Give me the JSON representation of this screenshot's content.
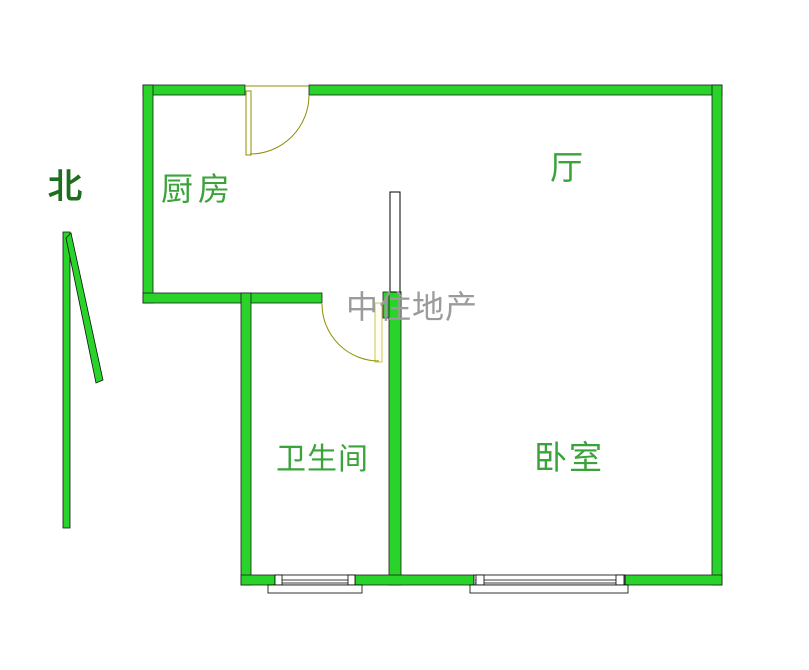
{
  "compass": {
    "label": "北"
  },
  "rooms": {
    "kitchen": {
      "label": "厨房"
    },
    "hall": {
      "label": "厅"
    },
    "bathroom": {
      "label": "卫生间"
    },
    "bedroom": {
      "label": "卧室"
    }
  },
  "watermark": {
    "text": "中住地产"
  },
  "colors": {
    "wall": "#2ad32a",
    "outline": "#1c1c1c",
    "roomLabel": "#3aa33a",
    "northLabel": "#1d6e1d",
    "watermark": "#9b9b9b",
    "door": "#8f8f00",
    "doorLeafLight": "#cfc355"
  }
}
